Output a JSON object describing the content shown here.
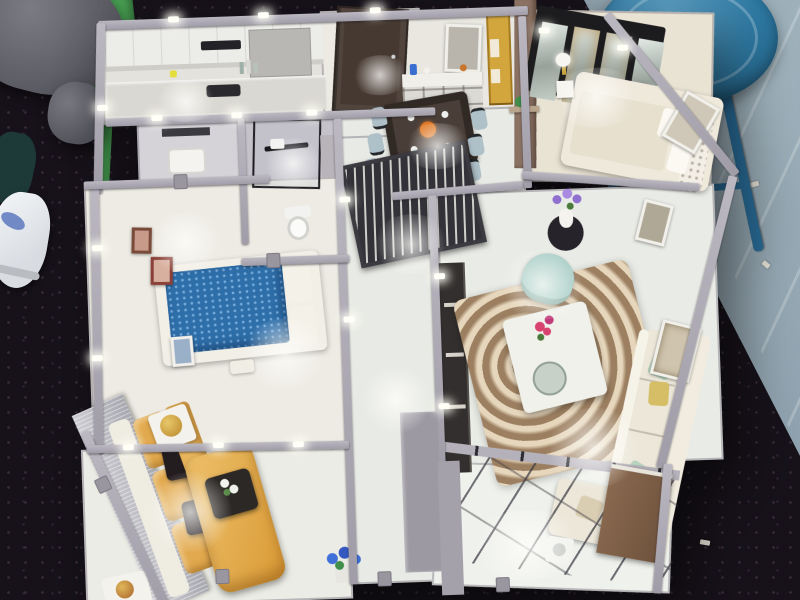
{
  "scene": {
    "type": "photograph",
    "subject": "overhead-view-of-miniature-apartment-scale-model-on-dark-exhibition-table",
    "surroundings": {
      "table_color": "#17121a",
      "glossy_floor_color": "#93a6b2",
      "stool_seat_color": "#2e7aa4",
      "stool_leg_color": "#2a6f9c",
      "person_leg_color": "#63646c",
      "green_chair_color": "#4aa455",
      "green_chair_leg_color": "#3f9149",
      "sneaker_color": "#edeff1",
      "sock_color": "#1e3a38"
    },
    "model": {
      "wall_color": "#aaa6af",
      "rooms": {
        "kitchen": {
          "label": "kitchen",
          "floor": "#e4e2dd",
          "cabinet": "#ecece9",
          "counter": "#dad8d2",
          "cooktop": "#2a2a2e",
          "hood_slot": "#232226",
          "bottle_yellow": "#e4de3c"
        },
        "entry": {
          "label": "entry hall",
          "floor": "#eceae2",
          "door": "#463931"
        },
        "dining": {
          "label": "dining room",
          "floor": "#e9e7e0",
          "table": "#4a3e38",
          "chair": "#aec0c8",
          "sideboard": "#dcdad4",
          "sideboard_top": "#f0efe9",
          "gold_cabinet": "#d2a63c",
          "wood_partition": "#8b7263",
          "centerpiece": "#e07a28",
          "vase_blue": "#3a6ed0",
          "plant": "#3f8f4a"
        },
        "bedroom_right": {
          "label": "bedroom with wardrobe",
          "floor": "#e9e3d4",
          "bed_base": "#efe9dc",
          "blanket": "#e7e0cf",
          "headboard": "#f3efe6",
          "wardrobe_frame": "#1c1c1e",
          "nightstand": "#f6f4ee",
          "lamp_gold": "#c9a43c"
        },
        "bathroom": {
          "label": "bathroom",
          "floor": "#c6c2ca",
          "vanity_floor": "#d6d3d8",
          "vanity": "#f4f3ef",
          "fixture": "#f2f2f0",
          "black_frame": "#1d1d22",
          "towel_bar": "#1a1a1e"
        },
        "hallway": {
          "label": "hallway",
          "floor": "#e8eae5",
          "screen": "#323238"
        },
        "bedroom_left": {
          "label": "bedroom with blue bed",
          "floor": "#edebe3",
          "bed_base": "#f2efe7",
          "mattress": "#2f6fa9",
          "pillow": "#f4f1e8",
          "frame_brown": "#7a4a3a",
          "frame_red": "#8a4038",
          "bench": "#f0ede4"
        },
        "living_left": {
          "label": "living room with gold sofa",
          "floor": "#ecece6",
          "sofa_back": "#efece2",
          "sofa_gold": "#e2a94e",
          "seat_gold": "#e8b55c",
          "pillow_black": "#241d20",
          "chaise": "#dfa342",
          "coffee_table": "#2c2826",
          "cube_table": "#f4f2ec",
          "ornament_gold": "#c89a3e"
        },
        "living_right": {
          "label": "living room with white sofa",
          "floor": "#e9ebe6",
          "sofa": "#ece7d9",
          "sofa_back": "#f1ecdf",
          "rug": "#b09272",
          "rug_swirl": "#e5d9c3",
          "coffee_table": "#f0f1ea",
          "armchair": "#a5cbc4",
          "tv_console": "#332f2e",
          "pillow_mint": "#b7d2bf",
          "pillow_gold": "#d6be66",
          "flowers_pink": "#d8446e",
          "flowers_purple": "#8f6fd0",
          "side_table": "#26242a"
        },
        "balcony": {
          "label": "glazed balcony",
          "floor": "#eff1ec",
          "cabinet": "#7c5e48",
          "appliance": "#f2f2ef",
          "flowers_blue": "#3f6fd8"
        }
      }
    }
  }
}
